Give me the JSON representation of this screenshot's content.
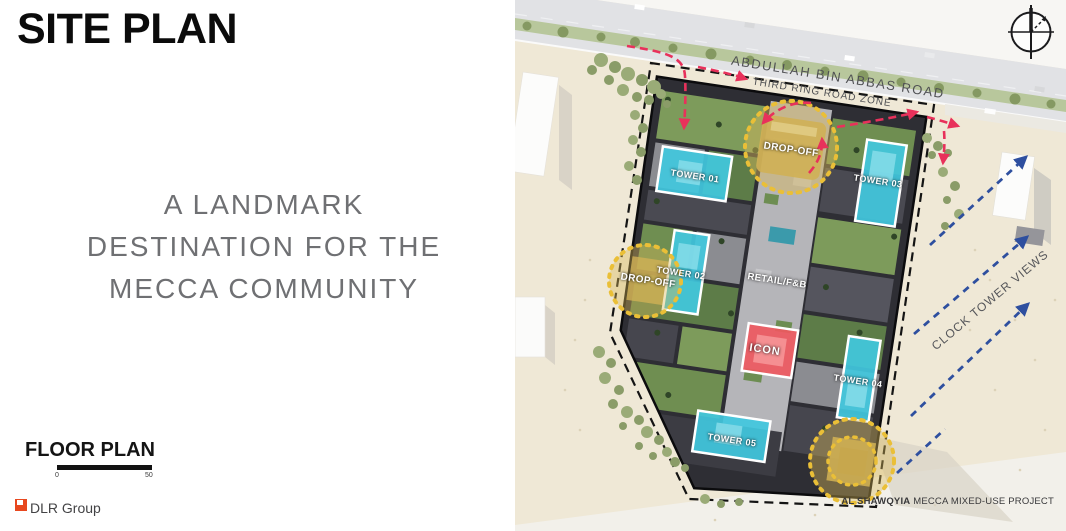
{
  "slide": {
    "title": "SITE PLAN",
    "tagline_lines": [
      "A LANDMARK",
      "DESTINATION FOR THE",
      "MECCA COMMUNITY"
    ],
    "floor_plan": {
      "label": "FLOOR PLAN",
      "scale_start": "0",
      "scale_end": "50"
    },
    "logo": {
      "text": "DLR Group",
      "mark_color": "#e8481f"
    }
  },
  "siteplan": {
    "road_label": "ABDULLAH BIN ABBAS ROAD",
    "road_zone_label": "THIRD RING ROAD ZONE",
    "towers": [
      "TOWER 01",
      "TOWER 02",
      "TOWER 03",
      "TOWER 04",
      "TOWER 05"
    ],
    "dropoff_labels": {
      "top": "DROP-OFF",
      "west": "DROP-OFF"
    },
    "retail_label": "RETAIL/F&B",
    "icon_label": "ICON",
    "views_label": "CLOCK TOWER VIEWS",
    "caption": {
      "bold": "AL SHAWQYIA",
      "rest": " MECCA MIXED-USE PROJECT"
    },
    "colors": {
      "tower_highlight": "#41c8de",
      "icon_highlight": "#ee595f",
      "dropoff_yellow": "#eabf37",
      "circulation_arrow_red": "#e8315b",
      "view_arrow_blue": "#2e4f9f",
      "sand": "#efe8d6",
      "road": "#e1e2e5"
    }
  }
}
